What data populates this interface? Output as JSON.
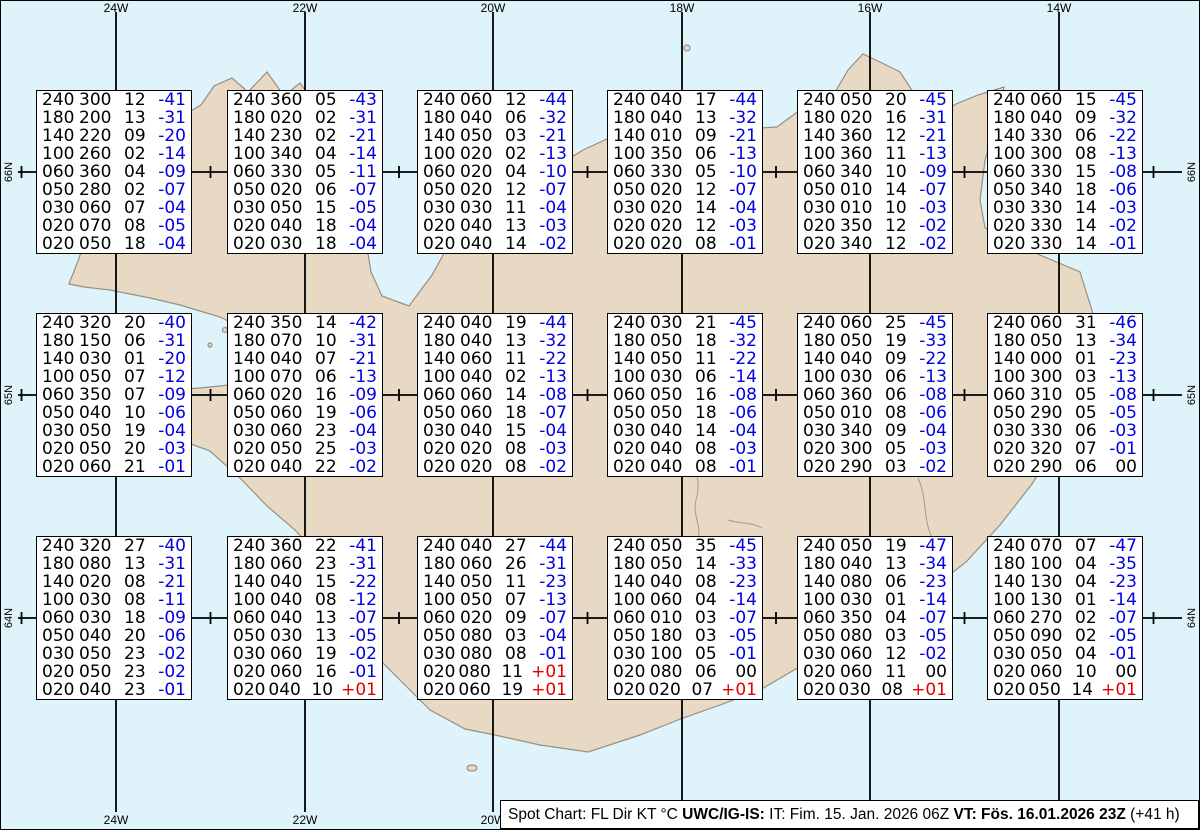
{
  "chart_data": {
    "type": "table",
    "title": "Spot Chart: FL Dir KT °C",
    "columns": [
      "FL",
      "Dir",
      "KT",
      "°C"
    ],
    "grid": {
      "meridians": [
        "24W",
        "22W",
        "20W",
        "18W",
        "16W",
        "14W"
      ],
      "parallels": [
        "66N",
        "65N",
        "64N"
      ]
    },
    "stations": [
      [
        [
          "240",
          "300",
          "12",
          "-41"
        ],
        [
          "180",
          "200",
          "13",
          "-31"
        ],
        [
          "140",
          "220",
          "09",
          "-20"
        ],
        [
          "100",
          "260",
          "02",
          "-14"
        ],
        [
          "060",
          "360",
          "04",
          "-09"
        ],
        [
          "050",
          "280",
          "02",
          "-07"
        ],
        [
          "030",
          "060",
          "07",
          "-04"
        ],
        [
          "020",
          "070",
          "08",
          "-05"
        ],
        [
          "020",
          "050",
          "18",
          "-04"
        ]
      ],
      [
        [
          "240",
          "360",
          "05",
          "-43"
        ],
        [
          "180",
          "020",
          "02",
          "-31"
        ],
        [
          "140",
          "230",
          "02",
          "-21"
        ],
        [
          "100",
          "340",
          "04",
          "-14"
        ],
        [
          "060",
          "330",
          "05",
          "-11"
        ],
        [
          "050",
          "020",
          "06",
          "-07"
        ],
        [
          "030",
          "050",
          "15",
          "-05"
        ],
        [
          "020",
          "040",
          "18",
          "-04"
        ],
        [
          "020",
          "030",
          "18",
          "-04"
        ]
      ],
      [
        [
          "240",
          "060",
          "12",
          "-44"
        ],
        [
          "180",
          "040",
          "06",
          "-32"
        ],
        [
          "140",
          "050",
          "03",
          "-21"
        ],
        [
          "100",
          "020",
          "02",
          "-13"
        ],
        [
          "060",
          "020",
          "04",
          "-10"
        ],
        [
          "050",
          "020",
          "12",
          "-07"
        ],
        [
          "030",
          "030",
          "11",
          "-04"
        ],
        [
          "020",
          "040",
          "13",
          "-03"
        ],
        [
          "020",
          "040",
          "14",
          "-02"
        ]
      ],
      [
        [
          "240",
          "040",
          "17",
          "-44"
        ],
        [
          "180",
          "040",
          "13",
          "-32"
        ],
        [
          "140",
          "010",
          "09",
          "-21"
        ],
        [
          "100",
          "350",
          "06",
          "-13"
        ],
        [
          "060",
          "330",
          "05",
          "-10"
        ],
        [
          "050",
          "020",
          "12",
          "-07"
        ],
        [
          "030",
          "020",
          "14",
          "-04"
        ],
        [
          "020",
          "020",
          "12",
          "-03"
        ],
        [
          "020",
          "020",
          "08",
          "-01"
        ]
      ],
      [
        [
          "240",
          "050",
          "20",
          "-45"
        ],
        [
          "180",
          "020",
          "16",
          "-31"
        ],
        [
          "140",
          "360",
          "12",
          "-21"
        ],
        [
          "100",
          "360",
          "11",
          "-13"
        ],
        [
          "060",
          "340",
          "10",
          "-09"
        ],
        [
          "050",
          "010",
          "14",
          "-07"
        ],
        [
          "030",
          "010",
          "10",
          "-03"
        ],
        [
          "020",
          "350",
          "12",
          "-02"
        ],
        [
          "020",
          "340",
          "12",
          "-02"
        ]
      ],
      [
        [
          "240",
          "060",
          "15",
          "-45"
        ],
        [
          "180",
          "040",
          "09",
          "-32"
        ],
        [
          "140",
          "330",
          "06",
          "-22"
        ],
        [
          "100",
          "300",
          "08",
          "-13"
        ],
        [
          "060",
          "330",
          "15",
          "-08"
        ],
        [
          "050",
          "340",
          "18",
          "-06"
        ],
        [
          "030",
          "330",
          "14",
          "-03"
        ],
        [
          "020",
          "330",
          "14",
          "-02"
        ],
        [
          "020",
          "330",
          "14",
          "-01"
        ]
      ],
      [
        [
          "240",
          "320",
          "20",
          "-40"
        ],
        [
          "180",
          "150",
          "06",
          "-31"
        ],
        [
          "140",
          "030",
          "01",
          "-20"
        ],
        [
          "100",
          "050",
          "07",
          "-12"
        ],
        [
          "060",
          "350",
          "07",
          "-09"
        ],
        [
          "050",
          "040",
          "10",
          "-06"
        ],
        [
          "030",
          "050",
          "19",
          "-04"
        ],
        [
          "020",
          "050",
          "20",
          "-03"
        ],
        [
          "020",
          "060",
          "21",
          "-01"
        ]
      ],
      [
        [
          "240",
          "350",
          "14",
          "-42"
        ],
        [
          "180",
          "070",
          "10",
          "-31"
        ],
        [
          "140",
          "040",
          "07",
          "-21"
        ],
        [
          "100",
          "070",
          "06",
          "-13"
        ],
        [
          "060",
          "020",
          "16",
          "-09"
        ],
        [
          "050",
          "060",
          "19",
          "-06"
        ],
        [
          "030",
          "060",
          "23",
          "-04"
        ],
        [
          "020",
          "050",
          "25",
          "-03"
        ],
        [
          "020",
          "040",
          "22",
          "-02"
        ]
      ],
      [
        [
          "240",
          "040",
          "19",
          "-44"
        ],
        [
          "180",
          "040",
          "13",
          "-32"
        ],
        [
          "140",
          "060",
          "11",
          "-22"
        ],
        [
          "100",
          "040",
          "02",
          "-13"
        ],
        [
          "060",
          "060",
          "14",
          "-08"
        ],
        [
          "050",
          "060",
          "18",
          "-07"
        ],
        [
          "030",
          "040",
          "15",
          "-04"
        ],
        [
          "020",
          "020",
          "08",
          "-03"
        ],
        [
          "020",
          "020",
          "08",
          "-02"
        ]
      ],
      [
        [
          "240",
          "030",
          "21",
          "-45"
        ],
        [
          "180",
          "050",
          "18",
          "-32"
        ],
        [
          "140",
          "050",
          "11",
          "-22"
        ],
        [
          "100",
          "030",
          "06",
          "-14"
        ],
        [
          "060",
          "050",
          "16",
          "-08"
        ],
        [
          "050",
          "050",
          "18",
          "-06"
        ],
        [
          "030",
          "040",
          "14",
          "-04"
        ],
        [
          "020",
          "040",
          "08",
          "-03"
        ],
        [
          "020",
          "040",
          "08",
          "-01"
        ]
      ],
      [
        [
          "240",
          "060",
          "25",
          "-45"
        ],
        [
          "180",
          "050",
          "19",
          "-33"
        ],
        [
          "140",
          "040",
          "09",
          "-22"
        ],
        [
          "100",
          "030",
          "06",
          "-13"
        ],
        [
          "060",
          "360",
          "06",
          "-08"
        ],
        [
          "050",
          "010",
          "08",
          "-06"
        ],
        [
          "030",
          "340",
          "09",
          "-04"
        ],
        [
          "020",
          "300",
          "05",
          "-03"
        ],
        [
          "020",
          "290",
          "03",
          "-02"
        ]
      ],
      [
        [
          "240",
          "060",
          "31",
          "-46"
        ],
        [
          "180",
          "050",
          "13",
          "-34"
        ],
        [
          "140",
          "000",
          "01",
          "-23"
        ],
        [
          "100",
          "300",
          "03",
          "-13"
        ],
        [
          "060",
          "310",
          "05",
          "-08"
        ],
        [
          "050",
          "290",
          "05",
          "-05"
        ],
        [
          "030",
          "330",
          "06",
          "-03"
        ],
        [
          "020",
          "320",
          "07",
          "-01"
        ],
        [
          "020",
          "290",
          "06",
          "00"
        ]
      ],
      [
        [
          "240",
          "320",
          "27",
          "-40"
        ],
        [
          "180",
          "080",
          "13",
          "-31"
        ],
        [
          "140",
          "020",
          "08",
          "-21"
        ],
        [
          "100",
          "030",
          "08",
          "-11"
        ],
        [
          "060",
          "030",
          "18",
          "-09"
        ],
        [
          "050",
          "040",
          "20",
          "-06"
        ],
        [
          "030",
          "050",
          "23",
          "-02"
        ],
        [
          "020",
          "050",
          "23",
          "-02"
        ],
        [
          "020",
          "040",
          "23",
          "-01"
        ]
      ],
      [
        [
          "240",
          "360",
          "22",
          "-41"
        ],
        [
          "180",
          "060",
          "23",
          "-31"
        ],
        [
          "140",
          "040",
          "15",
          "-22"
        ],
        [
          "100",
          "040",
          "08",
          "-12"
        ],
        [
          "060",
          "040",
          "13",
          "-07"
        ],
        [
          "050",
          "030",
          "13",
          "-05"
        ],
        [
          "030",
          "060",
          "19",
          "-02"
        ],
        [
          "020",
          "060",
          "16",
          "-01"
        ],
        [
          "020",
          "040",
          "10",
          "+01"
        ]
      ],
      [
        [
          "240",
          "040",
          "27",
          "-44"
        ],
        [
          "180",
          "060",
          "26",
          "-31"
        ],
        [
          "140",
          "050",
          "11",
          "-23"
        ],
        [
          "100",
          "050",
          "07",
          "-13"
        ],
        [
          "060",
          "020",
          "09",
          "-07"
        ],
        [
          "050",
          "080",
          "03",
          "-04"
        ],
        [
          "030",
          "080",
          "08",
          "-01"
        ],
        [
          "020",
          "080",
          "11",
          "+01"
        ],
        [
          "020",
          "060",
          "19",
          "+01"
        ]
      ],
      [
        [
          "240",
          "050",
          "35",
          "-45"
        ],
        [
          "180",
          "050",
          "14",
          "-33"
        ],
        [
          "140",
          "040",
          "08",
          "-23"
        ],
        [
          "100",
          "060",
          "04",
          "-14"
        ],
        [
          "060",
          "010",
          "03",
          "-07"
        ],
        [
          "050",
          "180",
          "03",
          "-05"
        ],
        [
          "030",
          "100",
          "05",
          "-01"
        ],
        [
          "020",
          "080",
          "06",
          "00"
        ],
        [
          "020",
          "020",
          "07",
          "+01"
        ]
      ],
      [
        [
          "240",
          "050",
          "19",
          "-47"
        ],
        [
          "180",
          "040",
          "13",
          "-34"
        ],
        [
          "140",
          "080",
          "06",
          "-23"
        ],
        [
          "100",
          "030",
          "01",
          "-14"
        ],
        [
          "060",
          "350",
          "04",
          "-07"
        ],
        [
          "050",
          "080",
          "03",
          "-05"
        ],
        [
          "030",
          "060",
          "12",
          "-02"
        ],
        [
          "020",
          "060",
          "11",
          "00"
        ],
        [
          "020",
          "030",
          "08",
          "+01"
        ]
      ],
      [
        [
          "240",
          "070",
          "07",
          "-47"
        ],
        [
          "180",
          "100",
          "04",
          "-35"
        ],
        [
          "140",
          "130",
          "04",
          "-23"
        ],
        [
          "100",
          "130",
          "01",
          "-14"
        ],
        [
          "060",
          "270",
          "02",
          "-07"
        ],
        [
          "050",
          "090",
          "02",
          "-05"
        ],
        [
          "030",
          "050",
          "04",
          "-01"
        ],
        [
          "020",
          "060",
          "10",
          "00"
        ],
        [
          "020",
          "050",
          "14",
          "+01"
        ]
      ]
    ]
  },
  "footer": {
    "parts": [
      {
        "text": "Spot Chart: FL Dir KT °C ",
        "bold": false
      },
      {
        "text": "UWC/IG-IS:",
        "bold": true
      },
      {
        "text": " IT: Fim. 15. Jan. 2026 06Z ",
        "bold": false
      },
      {
        "text": "VT: Fös. 16.01.2026 23Z",
        "bold": true
      },
      {
        "text": " (+41 h)",
        "bold": false
      }
    ]
  },
  "colors": {
    "water": "#DFF3FA",
    "land": "#E8D9C5",
    "coast": "#998F82",
    "grid": "#000000",
    "blue": "#0000E0",
    "red": "#E40000"
  }
}
